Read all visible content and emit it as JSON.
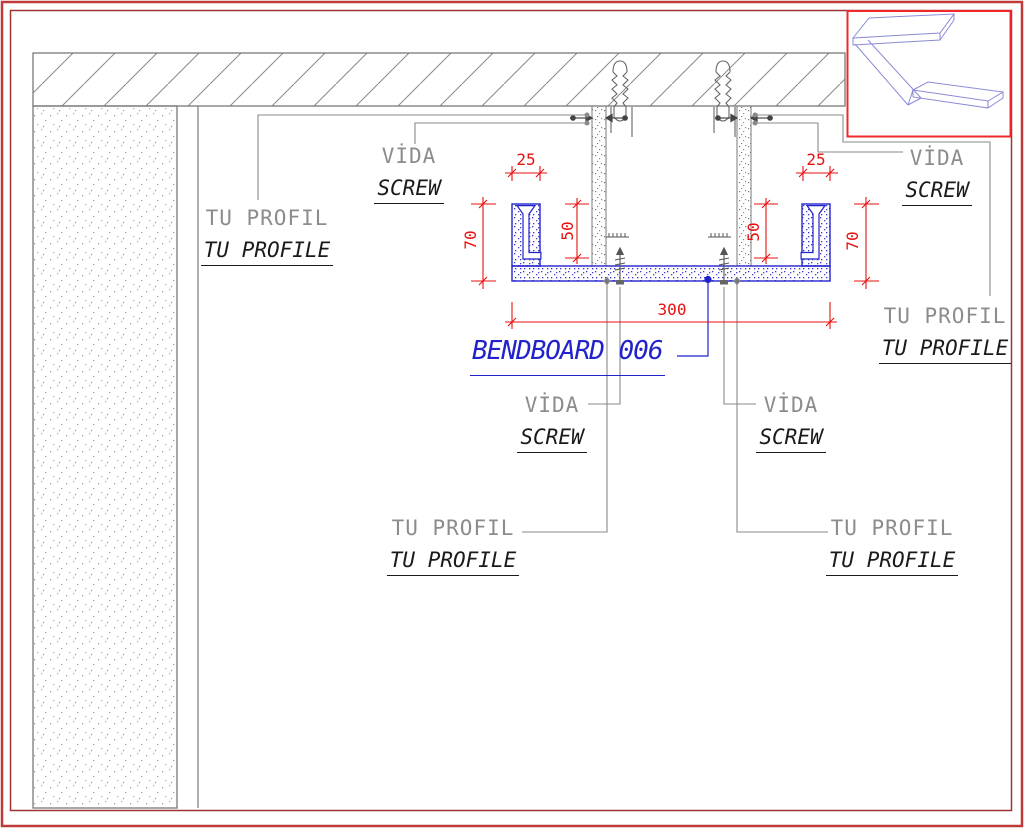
{
  "labels": {
    "vida": "VİDA",
    "screw": "SCREW",
    "tu_profil": "TU PROFIL",
    "tu_profile": "TU PROFILE",
    "product": "BENDBOARD 006"
  },
  "dimensions": {
    "flange_width": "25",
    "profile_height": "70",
    "inner_depth": "50",
    "board_width": "300"
  },
  "colors": {
    "dimension_red": "#e81010",
    "outer_frame_red": "#c03a3a",
    "inner_frame_red": "#9e3333",
    "inset_box_red": "#ef2929",
    "bendboard_blue": "#2222cc",
    "wireframe_blue": "#8a8ad6",
    "line_gray": "#7a7a7a",
    "label_gray": "#8c8c8c",
    "label_black": "#1a1a1a"
  }
}
